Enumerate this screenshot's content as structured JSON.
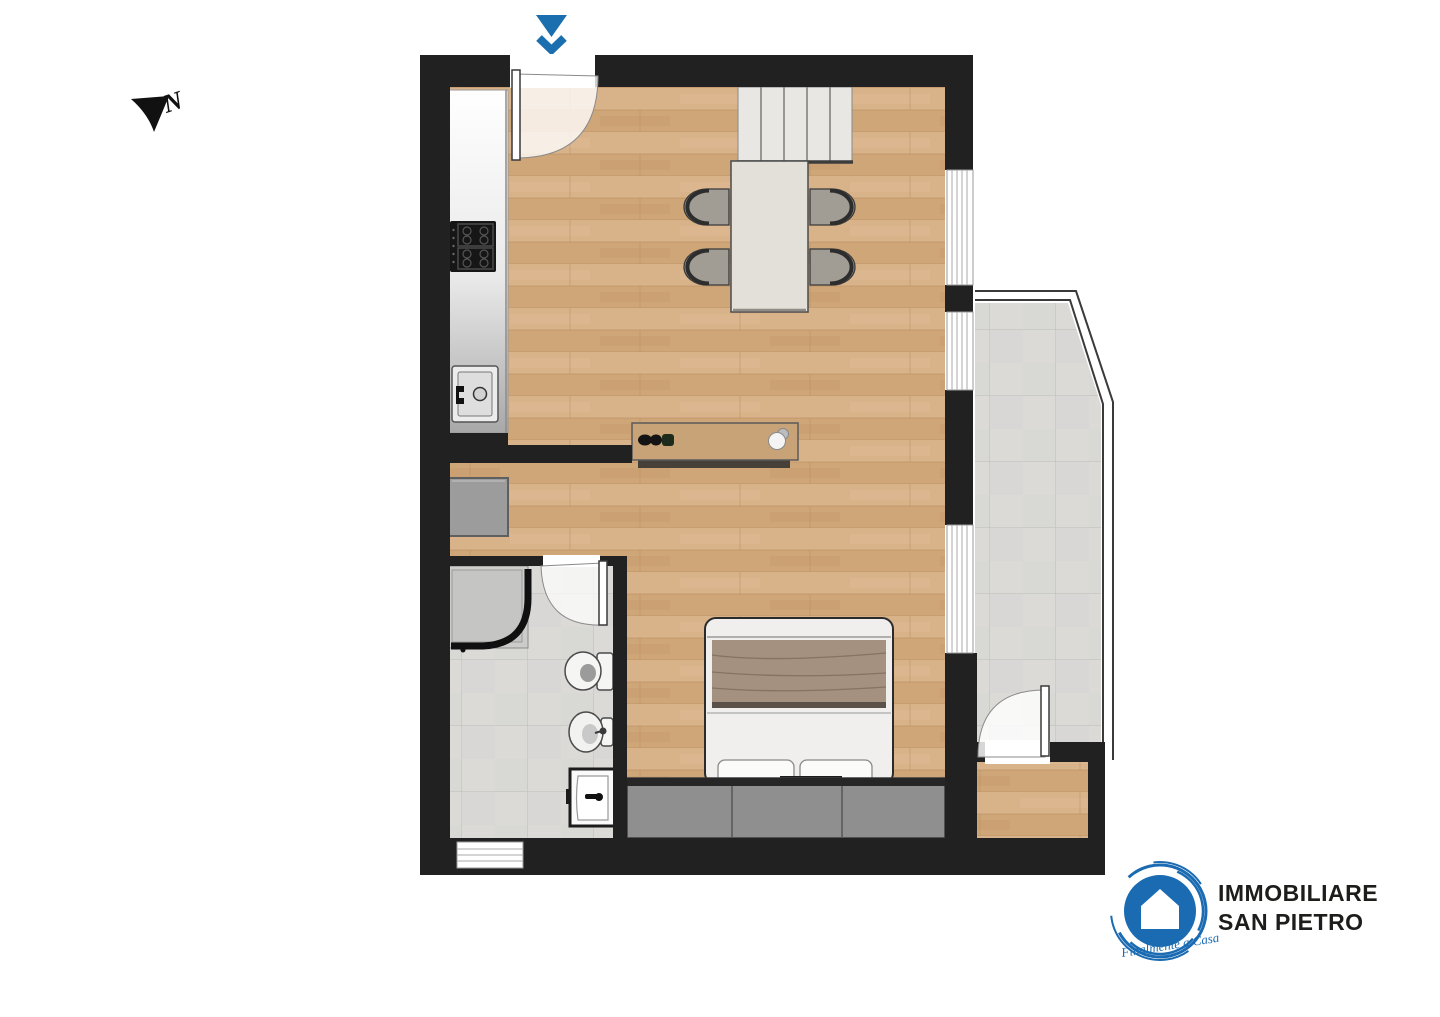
{
  "compass": {
    "label": "N"
  },
  "entrance": {
    "arrow_color": "#1c6fae"
  },
  "logo": {
    "line1": "IMMOBILIARE",
    "line2": "SAN PIETRO",
    "tagline": "Finalmente a Casa",
    "circle_color": "#1a6bb2",
    "text_color": "#1d1d1b"
  },
  "palette": {
    "wall": "#212121",
    "wood_floor": "#d4ad81",
    "tile_floor": "#dbdad7",
    "counter_gray": "#e6e6e6",
    "furniture_gray": "#8f8f8f",
    "bed_blanket": "#a5917f",
    "background": "#ffffff",
    "ink": "#111111"
  }
}
